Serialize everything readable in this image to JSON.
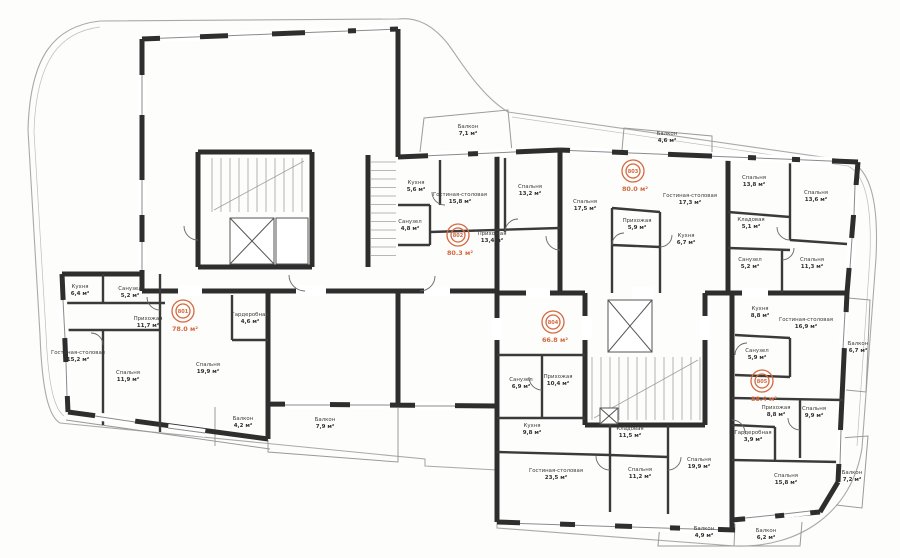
{
  "plan": {
    "units": "м²",
    "badge_color": "#d4683f",
    "apartments": [
      {
        "number": "801",
        "total_area": "78.0 м²",
        "x": 183,
        "y": 311
      },
      {
        "number": "802",
        "total_area": "80.3 м²",
        "x": 458,
        "y": 235
      },
      {
        "number": "803",
        "total_area": "80.0 м²",
        "x": 633,
        "y": 171
      },
      {
        "number": "804",
        "total_area": "66.8 м²",
        "x": 553,
        "y": 322
      },
      {
        "number": "805",
        "total_area": "88.4 м²",
        "x": 762,
        "y": 381
      }
    ],
    "rooms": [
      {
        "name": "Кухня",
        "area": "6,4 м²",
        "x": 80,
        "y": 288
      },
      {
        "name": "Санузел",
        "area": "5,2 м²",
        "x": 130,
        "y": 290
      },
      {
        "name": "Прихожая",
        "area": "11,7 м²",
        "x": 148,
        "y": 320
      },
      {
        "name": "Гардеробная",
        "area": "4,6 м²",
        "x": 250,
        "y": 316
      },
      {
        "name": "Гостиная-столовая",
        "area": "15,2 м²",
        "x": 78,
        "y": 354
      },
      {
        "name": "Спальня",
        "area": "11,9 м²",
        "x": 128,
        "y": 374
      },
      {
        "name": "Спальня",
        "area": "19,9 м²",
        "x": 208,
        "y": 366
      },
      {
        "name": "Балкон",
        "area": "4,2 м²",
        "x": 243,
        "y": 420
      },
      {
        "name": "Балкон",
        "area": "7,9 м²",
        "x": 325,
        "y": 421
      },
      {
        "name": "Балкон",
        "area": "7,1 м²",
        "x": 468,
        "y": 128
      },
      {
        "name": "Кухня",
        "area": "5,6 м²",
        "x": 416,
        "y": 184
      },
      {
        "name": "Гостиная-столовая",
        "area": "15,8 м²",
        "x": 460,
        "y": 196
      },
      {
        "name": "Спальня",
        "area": "13,2 м²",
        "x": 530,
        "y": 188
      },
      {
        "name": "Санузел",
        "area": "4,8 м²",
        "x": 410,
        "y": 223
      },
      {
        "name": "Прихожая",
        "area": "13,4 м²",
        "x": 492,
        "y": 235
      },
      {
        "name": "Спальня",
        "area": "17,5 м²",
        "x": 585,
        "y": 203
      },
      {
        "name": "Балкон",
        "area": "4,6 м²",
        "x": 667,
        "y": 135
      },
      {
        "name": "Гостиная-столовая",
        "area": "17,3 м²",
        "x": 690,
        "y": 197
      },
      {
        "name": "Прихожая",
        "area": "5,9 м²",
        "x": 637,
        "y": 222
      },
      {
        "name": "Кухня",
        "area": "6,7 м²",
        "x": 686,
        "y": 237
      },
      {
        "name": "Спальня",
        "area": "13,8 м²",
        "x": 754,
        "y": 179
      },
      {
        "name": "Спальня",
        "area": "13,6 м²",
        "x": 816,
        "y": 194
      },
      {
        "name": "Кладовая",
        "area": "5,1 м²",
        "x": 751,
        "y": 221
      },
      {
        "name": "Санузел",
        "area": "5,2 м²",
        "x": 750,
        "y": 261
      },
      {
        "name": "Спальня",
        "area": "11,3 м²",
        "x": 812,
        "y": 261
      },
      {
        "name": "Санузел",
        "area": "6,9 м²",
        "x": 521,
        "y": 381
      },
      {
        "name": "Прихожая",
        "area": "10,4 м²",
        "x": 558,
        "y": 378
      },
      {
        "name": "Кухня",
        "area": "9,8 м²",
        "x": 532,
        "y": 427
      },
      {
        "name": "Гостиная-столовая",
        "area": "23,5 м²",
        "x": 556,
        "y": 472
      },
      {
        "name": "Кладовая",
        "area": "11,5 м²",
        "x": 630,
        "y": 430
      },
      {
        "name": "Спальня",
        "area": "11,2 м²",
        "x": 640,
        "y": 471
      },
      {
        "name": "Спальня",
        "area": "19,9 м²",
        "x": 699,
        "y": 461
      },
      {
        "name": "Балкон",
        "area": "4,9 м²",
        "x": 704,
        "y": 530
      },
      {
        "name": "Балкон",
        "area": "6,2 м²",
        "x": 766,
        "y": 532
      },
      {
        "name": "Кухня",
        "area": "8,8 м²",
        "x": 760,
        "y": 310
      },
      {
        "name": "Гостиная-столовая",
        "area": "16,9 м²",
        "x": 806,
        "y": 321
      },
      {
        "name": "Санузел",
        "area": "5,9 м²",
        "x": 757,
        "y": 352
      },
      {
        "name": "Прихожая",
        "area": "8,8 м²",
        "x": 776,
        "y": 409
      },
      {
        "name": "Спальня",
        "area": "9,9 м²",
        "x": 814,
        "y": 410
      },
      {
        "name": "Гардеробная",
        "area": "3,9 м²",
        "x": 753,
        "y": 434
      },
      {
        "name": "Спальня",
        "area": "15,8 м²",
        "x": 786,
        "y": 477
      },
      {
        "name": "Балкон",
        "area": "6,7 м²",
        "x": 858,
        "y": 345
      },
      {
        "name": "Балкон",
        "area": "7,2 м²",
        "x": 852,
        "y": 474
      }
    ]
  }
}
